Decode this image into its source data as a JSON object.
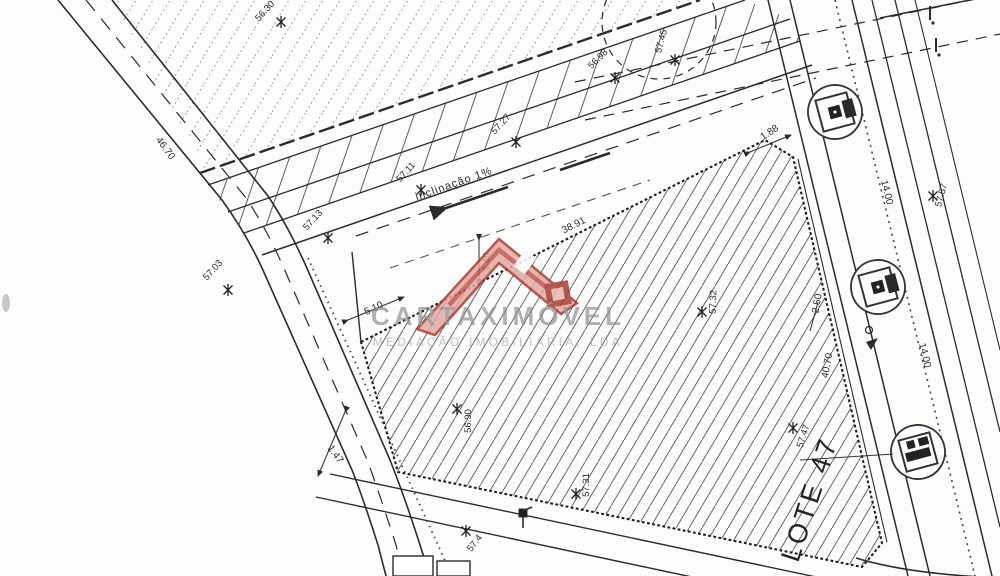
{
  "watermark": {
    "brand": "CARTAXIMÓVEL",
    "subtitle": "MEDIAÇÃO IMOBILIÁRIA, LDA",
    "logo_fill": "#e2a9a3",
    "logo_stroke": "#a83c34",
    "text_color": "#8f8f8f"
  },
  "plan": {
    "lot_label": "LOTE 47",
    "slope_label": "inclinação 1%",
    "line_color": "#2b2b2b",
    "hatch_color": "#555555",
    "dimensions": {
      "top_edge": "38.91",
      "left_edge": "5.10",
      "setback": "3.40",
      "corner_cut": "1.88",
      "right_offset": "2.50",
      "right_edge": "40.70",
      "left_road": "46.70",
      "bottom_gap": "1.47",
      "right_road_a": "14.00",
      "right_road_b": "14.00"
    },
    "spot_heights": {
      "a": "56.30",
      "b": "56.98",
      "c": "57.45",
      "d": "57.27",
      "e": "57.11",
      "f": "57.13",
      "g": "57.03",
      "h": "57.57",
      "i": "57.32",
      "j": "56.90",
      "k": "57.31",
      "l": "57.47",
      "m": "57.4"
    }
  }
}
